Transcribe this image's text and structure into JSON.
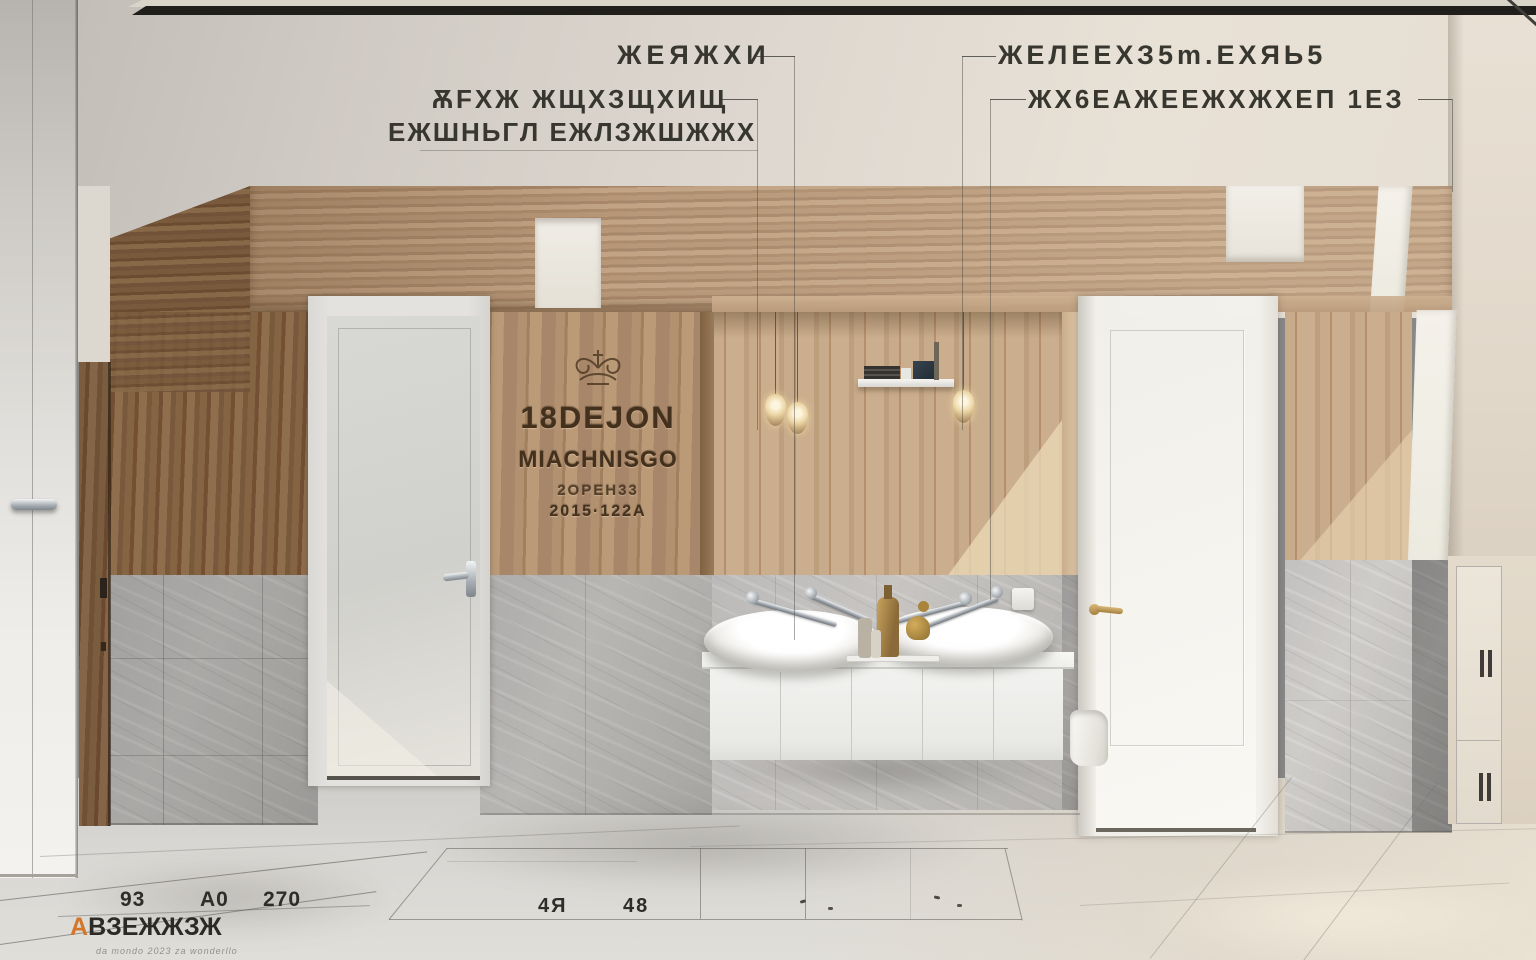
{
  "annotations": {
    "left_top": {
      "text": "ЖЕЯЖХИ"
    },
    "left_block": {
      "line1": "ѪFХЖ  ЖЩХЗЩХИЩ",
      "line2": "ЕЖШНЬΓЛ  ЕЖЛЗЖШЖЖХ"
    },
    "right_top": {
      "text": "ЖЕЛЕЕХЗ5m.ЕХЯЬ5"
    },
    "right_second": {
      "text": "ЖХ6ЕАЖЕЕЖХЖХЕП 1ЕЗ"
    }
  },
  "wall_logo": {
    "title": "18DEJON",
    "subtitle": "MIACHNISGO",
    "line3": "2OPEH33",
    "line4": "2015·122A"
  },
  "floor_marks": {
    "left": [
      "93",
      "A0",
      "270"
    ],
    "center": [
      "4Я",
      "48"
    ]
  },
  "watermark": {
    "logo_a": "A",
    "logo_b": "B",
    "brand": "ЗЕЖЖЗЖ",
    "tagline": "da mondo 2023 za wonderllo"
  },
  "colors": {
    "oak": "#b59575",
    "walnut": "#7b5c3e",
    "tile_gray": "#b3b1ad",
    "annotation_ink": "#3a3934",
    "brass": "#b08d4f",
    "watermark_orange": "#d4762a"
  }
}
